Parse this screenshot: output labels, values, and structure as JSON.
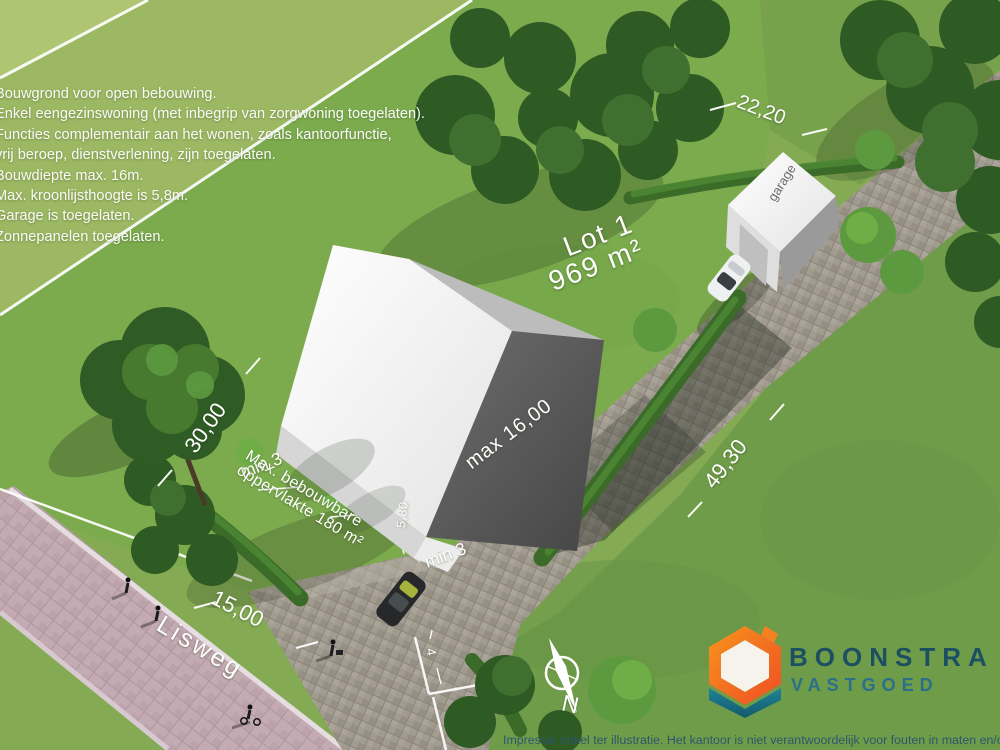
{
  "notes": {
    "lines": [
      "Bouwgrond voor open bebouwing.",
      "Enkel eengezinswoning (met inbegrip van zorgwoning toegelaten).",
      "Functies complementair aan het wonen, zoals kantoorfunctie,",
      "vrij beroep, dienstverlening, zijn toegelaten.",
      "Bouwdiepte max. 16m.",
      "Max. kroonlijsthoogte is 5,8m.",
      "Garage is toegelaten.",
      "Zonnepanelen toegelaten."
    ]
  },
  "lot": {
    "name": "Lot 1",
    "area": "969 m²"
  },
  "dimensions": {
    "left_side": "30,00",
    "frontage": "15,00",
    "right_side": "49,30",
    "back_side": "22,20",
    "facade_height": "5,80",
    "access_width": "4",
    "max_building_depth": "max 16,00",
    "min_side_left": "min 3",
    "min_side_right": "min 3",
    "max_area_line1": "Max. bebouwbare",
    "max_area_line2": "oppervlakte 180 m²"
  },
  "street": {
    "name": "Lisweg"
  },
  "garage": {
    "label": "garage"
  },
  "compass": {
    "north": "N"
  },
  "logo": {
    "name": "BOONSTRA",
    "subtitle": "VASTGOED",
    "orange": "#F58220",
    "orange_dark": "#EF4E23",
    "teal": "#1B7A8E",
    "text_color": "#1D4F63"
  },
  "footer": {
    "disclaimer": "Impressie enkel ter illustratie. Het kantoor is niet verantwoordelijk voor fouten in maten en/of plann"
  }
}
